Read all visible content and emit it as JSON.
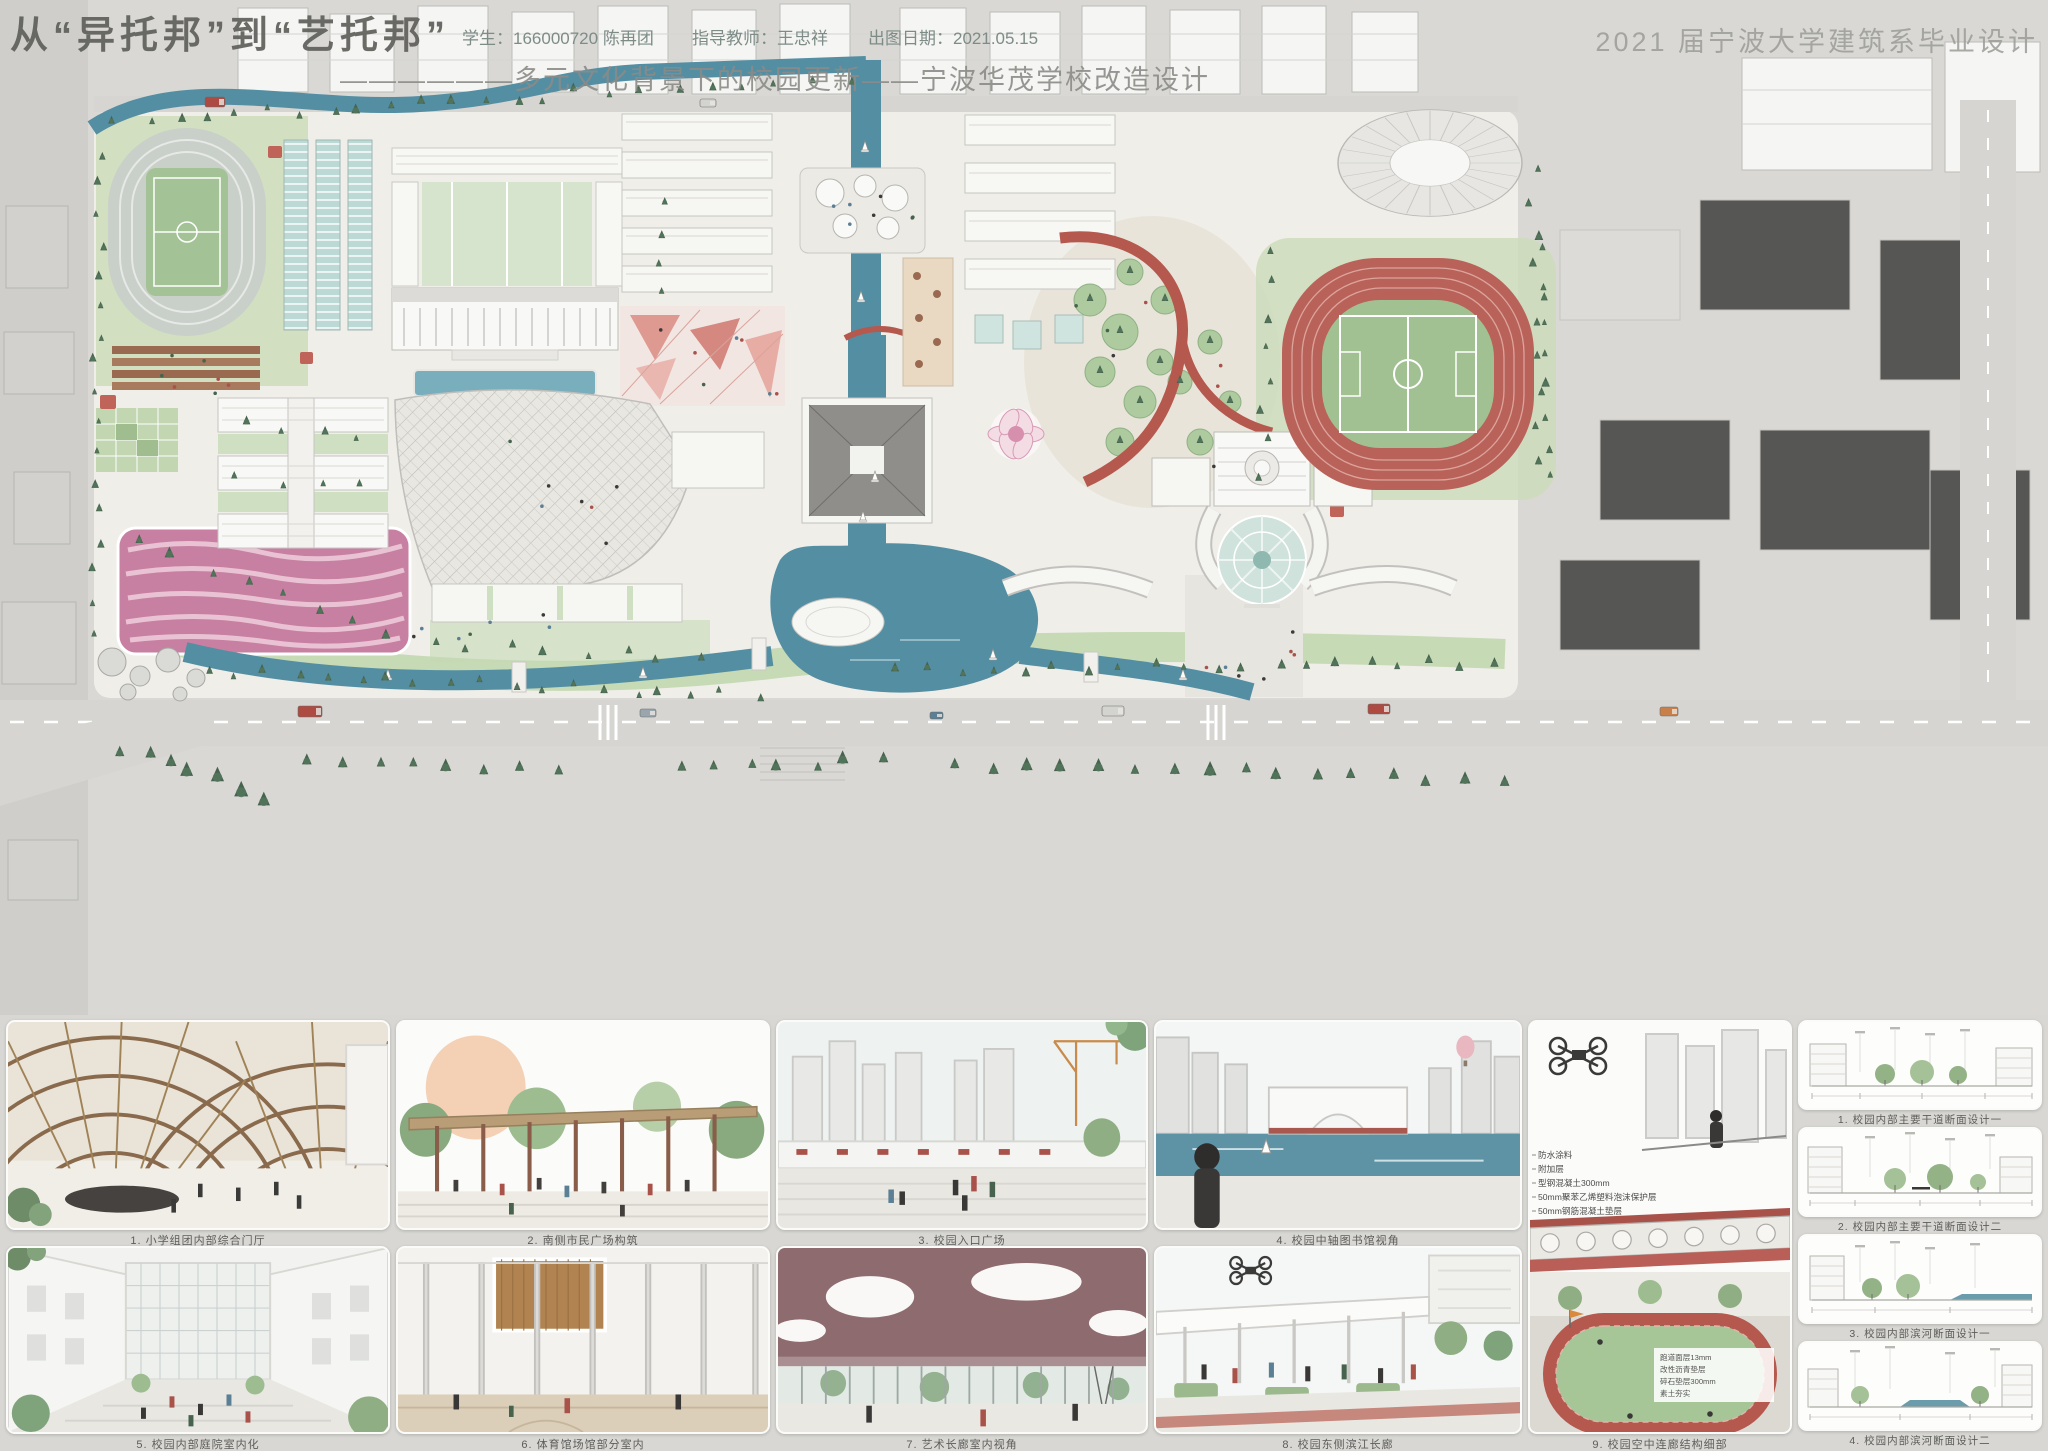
{
  "header": {
    "title": "从“异托邦”到“艺托邦”",
    "student": "学生：166000720  陈再团",
    "advisor": "指导教师：王忠祥",
    "date": "出图日期：2021.05.15",
    "program": "2021 届宁波大学建筑系毕业设计",
    "subtitle": "——————多元文化背景下的校园更新——宁波华茂学校改造设计"
  },
  "gallery": {
    "renderings": [
      {
        "caption": "1. 小学组团内部综合门厅"
      },
      {
        "caption": "2. 南侧市民广场构筑"
      },
      {
        "caption": "3. 校园入口广场"
      },
      {
        "caption": "4. 校园中轴图书馆视角"
      },
      {
        "caption": "5. 校园内部庭院室内化"
      },
      {
        "caption": "6. 体育馆场馆部分室内"
      },
      {
        "caption": "7. 艺术长廊室内视角"
      },
      {
        "caption": "8. 校园东侧滨江长廊"
      },
      {
        "caption": "9. 校园空中连廊结构细部"
      }
    ],
    "sections": [
      {
        "caption": "1. 校园内部主要干道断面设计一"
      },
      {
        "caption": "2. 校园内部主要干道断面设计二"
      },
      {
        "caption": "3. 校园内部滨河断面设计一"
      },
      {
        "caption": "4. 校园内部滨河断面设计二"
      }
    ]
  },
  "detail_labels": {
    "roof": [
      "防水涂料",
      "附加层",
      "型钢混凝土300mm",
      "50mm聚苯乙烯塑料泡沫保护层",
      "50mm钢筋混凝土垫层"
    ],
    "track": [
      "跑道面层13mm",
      "改性沥青垫层",
      "碎石垫层300mm",
      "素土夯实"
    ]
  },
  "colors": {
    "water": "#548ea3",
    "track_red": "#b5584e",
    "field_green": "#a2c193",
    "playground_pink": "#c77fa2",
    "accent_redbrown": "#a8524a"
  }
}
